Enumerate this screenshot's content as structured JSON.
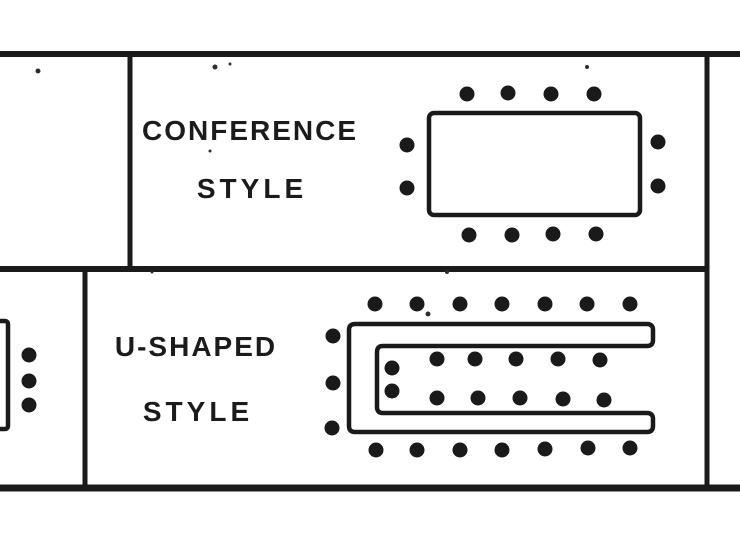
{
  "style": {
    "ink": "#1a1a1a",
    "background": "#ffffff",
    "seat_dot_diameter_px": 15,
    "speck_color": "#2e2e2e"
  },
  "conference": {
    "label": [
      "CONFERENCE",
      "STYLE"
    ],
    "seats": [
      [
        467,
        94
      ],
      [
        508,
        93
      ],
      [
        551,
        94
      ],
      [
        594,
        94
      ],
      [
        407,
        145
      ],
      [
        407,
        188
      ],
      [
        658,
        142
      ],
      [
        658,
        186
      ],
      [
        469,
        235
      ],
      [
        512,
        235
      ],
      [
        553,
        234
      ],
      [
        596,
        234
      ]
    ]
  },
  "u_shaped": {
    "label": [
      "U-SHAPED",
      "STYLE"
    ],
    "seats_outer": [
      [
        375,
        304
      ],
      [
        417,
        304
      ],
      [
        460,
        304
      ],
      [
        502,
        304
      ],
      [
        545,
        304
      ],
      [
        587,
        304
      ],
      [
        630,
        304
      ],
      [
        333,
        336
      ],
      [
        333,
        383
      ],
      [
        332,
        428
      ],
      [
        376,
        450
      ],
      [
        417,
        450
      ],
      [
        460,
        450
      ],
      [
        502,
        450
      ],
      [
        545,
        449
      ],
      [
        588,
        448
      ],
      [
        630,
        448
      ]
    ],
    "seats_inner": [
      [
        392,
        368
      ],
      [
        392,
        391
      ],
      [
        437,
        359
      ],
      [
        475,
        359
      ],
      [
        516,
        359
      ],
      [
        558,
        359
      ],
      [
        600,
        360
      ],
      [
        437,
        398
      ],
      [
        478,
        398
      ],
      [
        520,
        398
      ],
      [
        563,
        399
      ],
      [
        604,
        400
      ]
    ]
  },
  "adjacent_partial": {
    "seats": [
      [
        29,
        355
      ],
      [
        29,
        381
      ],
      [
        29,
        405
      ]
    ]
  },
  "scan_specks": [
    [
      38,
      71,
      5
    ],
    [
      215,
      67,
      5
    ],
    [
      230,
      64,
      3
    ],
    [
      587,
      67,
      4
    ],
    [
      210,
      151,
      3
    ],
    [
      428,
      314,
      5
    ],
    [
      152,
      272,
      3
    ],
    [
      447,
      272,
      4
    ]
  ]
}
